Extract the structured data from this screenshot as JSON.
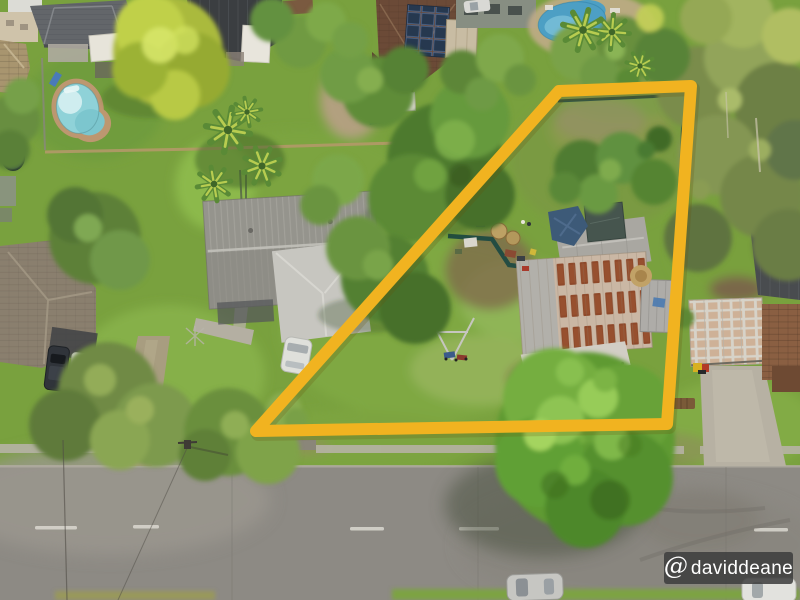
{
  "scene": {
    "type": "aerial-drone-photo",
    "subject": "suburban residential lots with a highlighted property boundary"
  },
  "boundary": {
    "color": "#f1b320",
    "outline_points": "256,431 559,91 691,86 667,424",
    "stroke_width": 12
  },
  "watermark": {
    "at_symbol": "@",
    "text": "daviddeane",
    "bg_color": "#3d3d3d",
    "text_color": "#ffffff"
  },
  "palette": {
    "grass": "#79a13e",
    "road": "#8d8a84",
    "rust_roof": "#8a4527",
    "gray_metal_roof": "#95948d",
    "pool_water_teal": "#3f7a6e",
    "pool_water_aqua": "#8fd2d8",
    "pool_water_blue": "#4d9fc4",
    "tree_canopy": "#5f9a33"
  }
}
